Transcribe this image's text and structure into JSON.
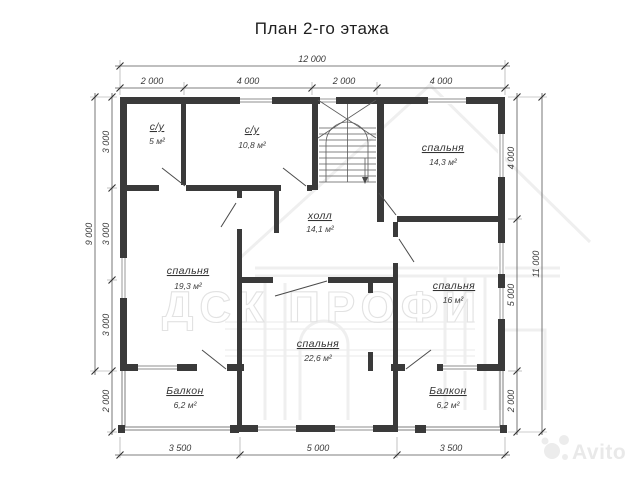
{
  "title": "План 2-го этажа",
  "watermark": {
    "brand": "ДСК ПРОФИ",
    "site": "Avito"
  },
  "rooms": [
    {
      "name": "с/у",
      "area": "5 м²"
    },
    {
      "name": "с/у",
      "area": "10,8 м²"
    },
    {
      "name": "спальня",
      "area": "14,3 м²"
    },
    {
      "name": "холл",
      "area": "14,1 м²"
    },
    {
      "name": "спальня",
      "area": "19,3 м²"
    },
    {
      "name": "спальня",
      "area": "16 м²"
    },
    {
      "name": "спальня",
      "area": "22,6 м²"
    },
    {
      "name": "Балкон",
      "area": "6,2 м²"
    },
    {
      "name": "Балкон",
      "area": "6,2 м²"
    }
  ],
  "dimensions": {
    "top_total": "12 000",
    "top": [
      "2 000",
      "4 000",
      "2 000",
      "4 000"
    ],
    "bottom": [
      "3 500",
      "5 000",
      "3 500"
    ],
    "left_total": "9 000",
    "left": [
      "3 000",
      "3 000",
      "3 000",
      "2 000"
    ],
    "right_total": "11 000",
    "right": [
      "4 000",
      "5 000",
      "2 000"
    ]
  }
}
